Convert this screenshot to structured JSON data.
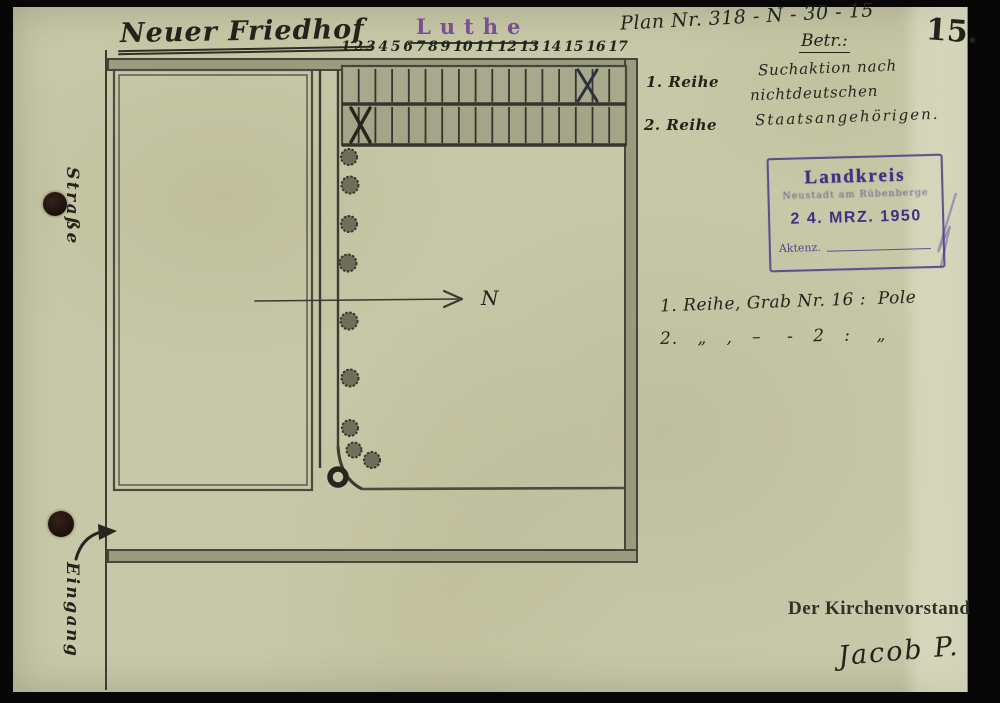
{
  "page": {
    "sheet_number": "15.",
    "plan_ref": "Plan Nr. 318 - N - 30 - 15",
    "betreff_label": "Betr.:",
    "subject_line1": "Suchaktion nach",
    "subject_line2": "nichtdeutschen",
    "subject_line3": "Staatsangehörigen."
  },
  "plan": {
    "title": "Neuer Friedhof",
    "place_title": "Luthe",
    "grave_numbers": [
      "1",
      "2",
      "3",
      "4",
      "5",
      "6",
      "7",
      "8",
      "9",
      "10",
      "11",
      "12",
      "13",
      "14",
      "15",
      "16",
      "17"
    ],
    "row1_label": "1. Reihe",
    "row2_label": "2. Reihe",
    "north_label": "N",
    "street_label": "Straße",
    "entrance_label": "Eingang",
    "marked_graves": [
      {
        "row": "1. Reihe",
        "grave": "16",
        "nationality": "Pole"
      },
      {
        "row": "2. Reihe",
        "grave": "2",
        "nationality": "Pole"
      }
    ]
  },
  "stamp": {
    "authority": "Landkreis",
    "place": "Neustadt am Rübenberge",
    "date": "2 4. MRZ. 1950",
    "file_ref_label": "Aktenz."
  },
  "notes": {
    "line1": "1. Reihe, Grab Nr. 16 :  Pole",
    "line2": "2.   „   ,   –    -   2   :    „"
  },
  "signoff": {
    "organization": "Der Kirchenvorstand",
    "signature": "Jacob P."
  },
  "colors": {
    "paper": "#c7c8a7",
    "pencil": "#3f3f36",
    "ink": "#23231c",
    "stamp_purple": "#403284",
    "place_purple": "#7b4f93",
    "background": "#070707"
  }
}
